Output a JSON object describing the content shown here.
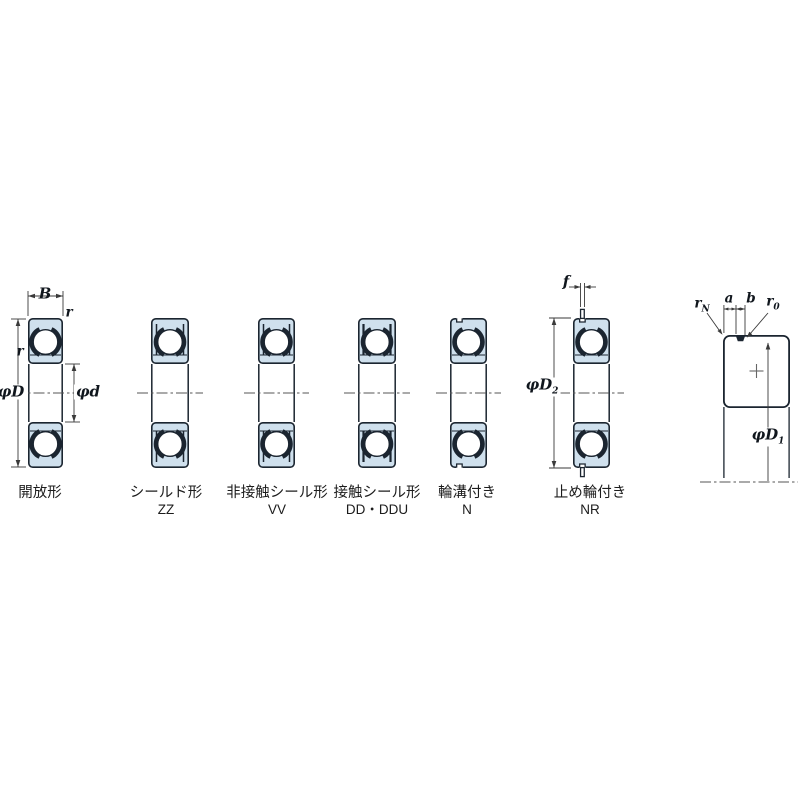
{
  "figure": {
    "title": "deep-groove-ball-bearing-type-chart",
    "bearings": [
      {
        "name": "開放形",
        "code": "",
        "variant": "open"
      },
      {
        "name": "シールド形",
        "code": "ZZ",
        "variant": "shield"
      },
      {
        "name": "非接触シール形",
        "code": "VV",
        "variant": "non-contact-seal"
      },
      {
        "name": "接触シール形",
        "code": "DD・DDU",
        "variant": "contact-seal"
      },
      {
        "name": "輪溝付き",
        "code": "N",
        "variant": "snap-ring-groove"
      },
      {
        "name": "止め輪付き",
        "code": "NR",
        "variant": "snap-ring-fitted"
      }
    ],
    "dimensions": {
      "B": "B",
      "r_outer": "r",
      "r_inner": "r",
      "phiD": "φD",
      "phid": "φd",
      "f": "f",
      "phiD2_base": "φD",
      "phiD2_sub": "2",
      "a": "a",
      "b": "b",
      "rN_base": "r",
      "rN_sub": "N",
      "r0_base": "r",
      "r0_sub": "0",
      "phiD1_base": "φD",
      "phiD1_sub": "1"
    },
    "colors": {
      "ring_fill": "#cfe0ed",
      "line": "#1b2530",
      "dim_line": "#3a3a3a",
      "centerline": "#555555"
    }
  }
}
